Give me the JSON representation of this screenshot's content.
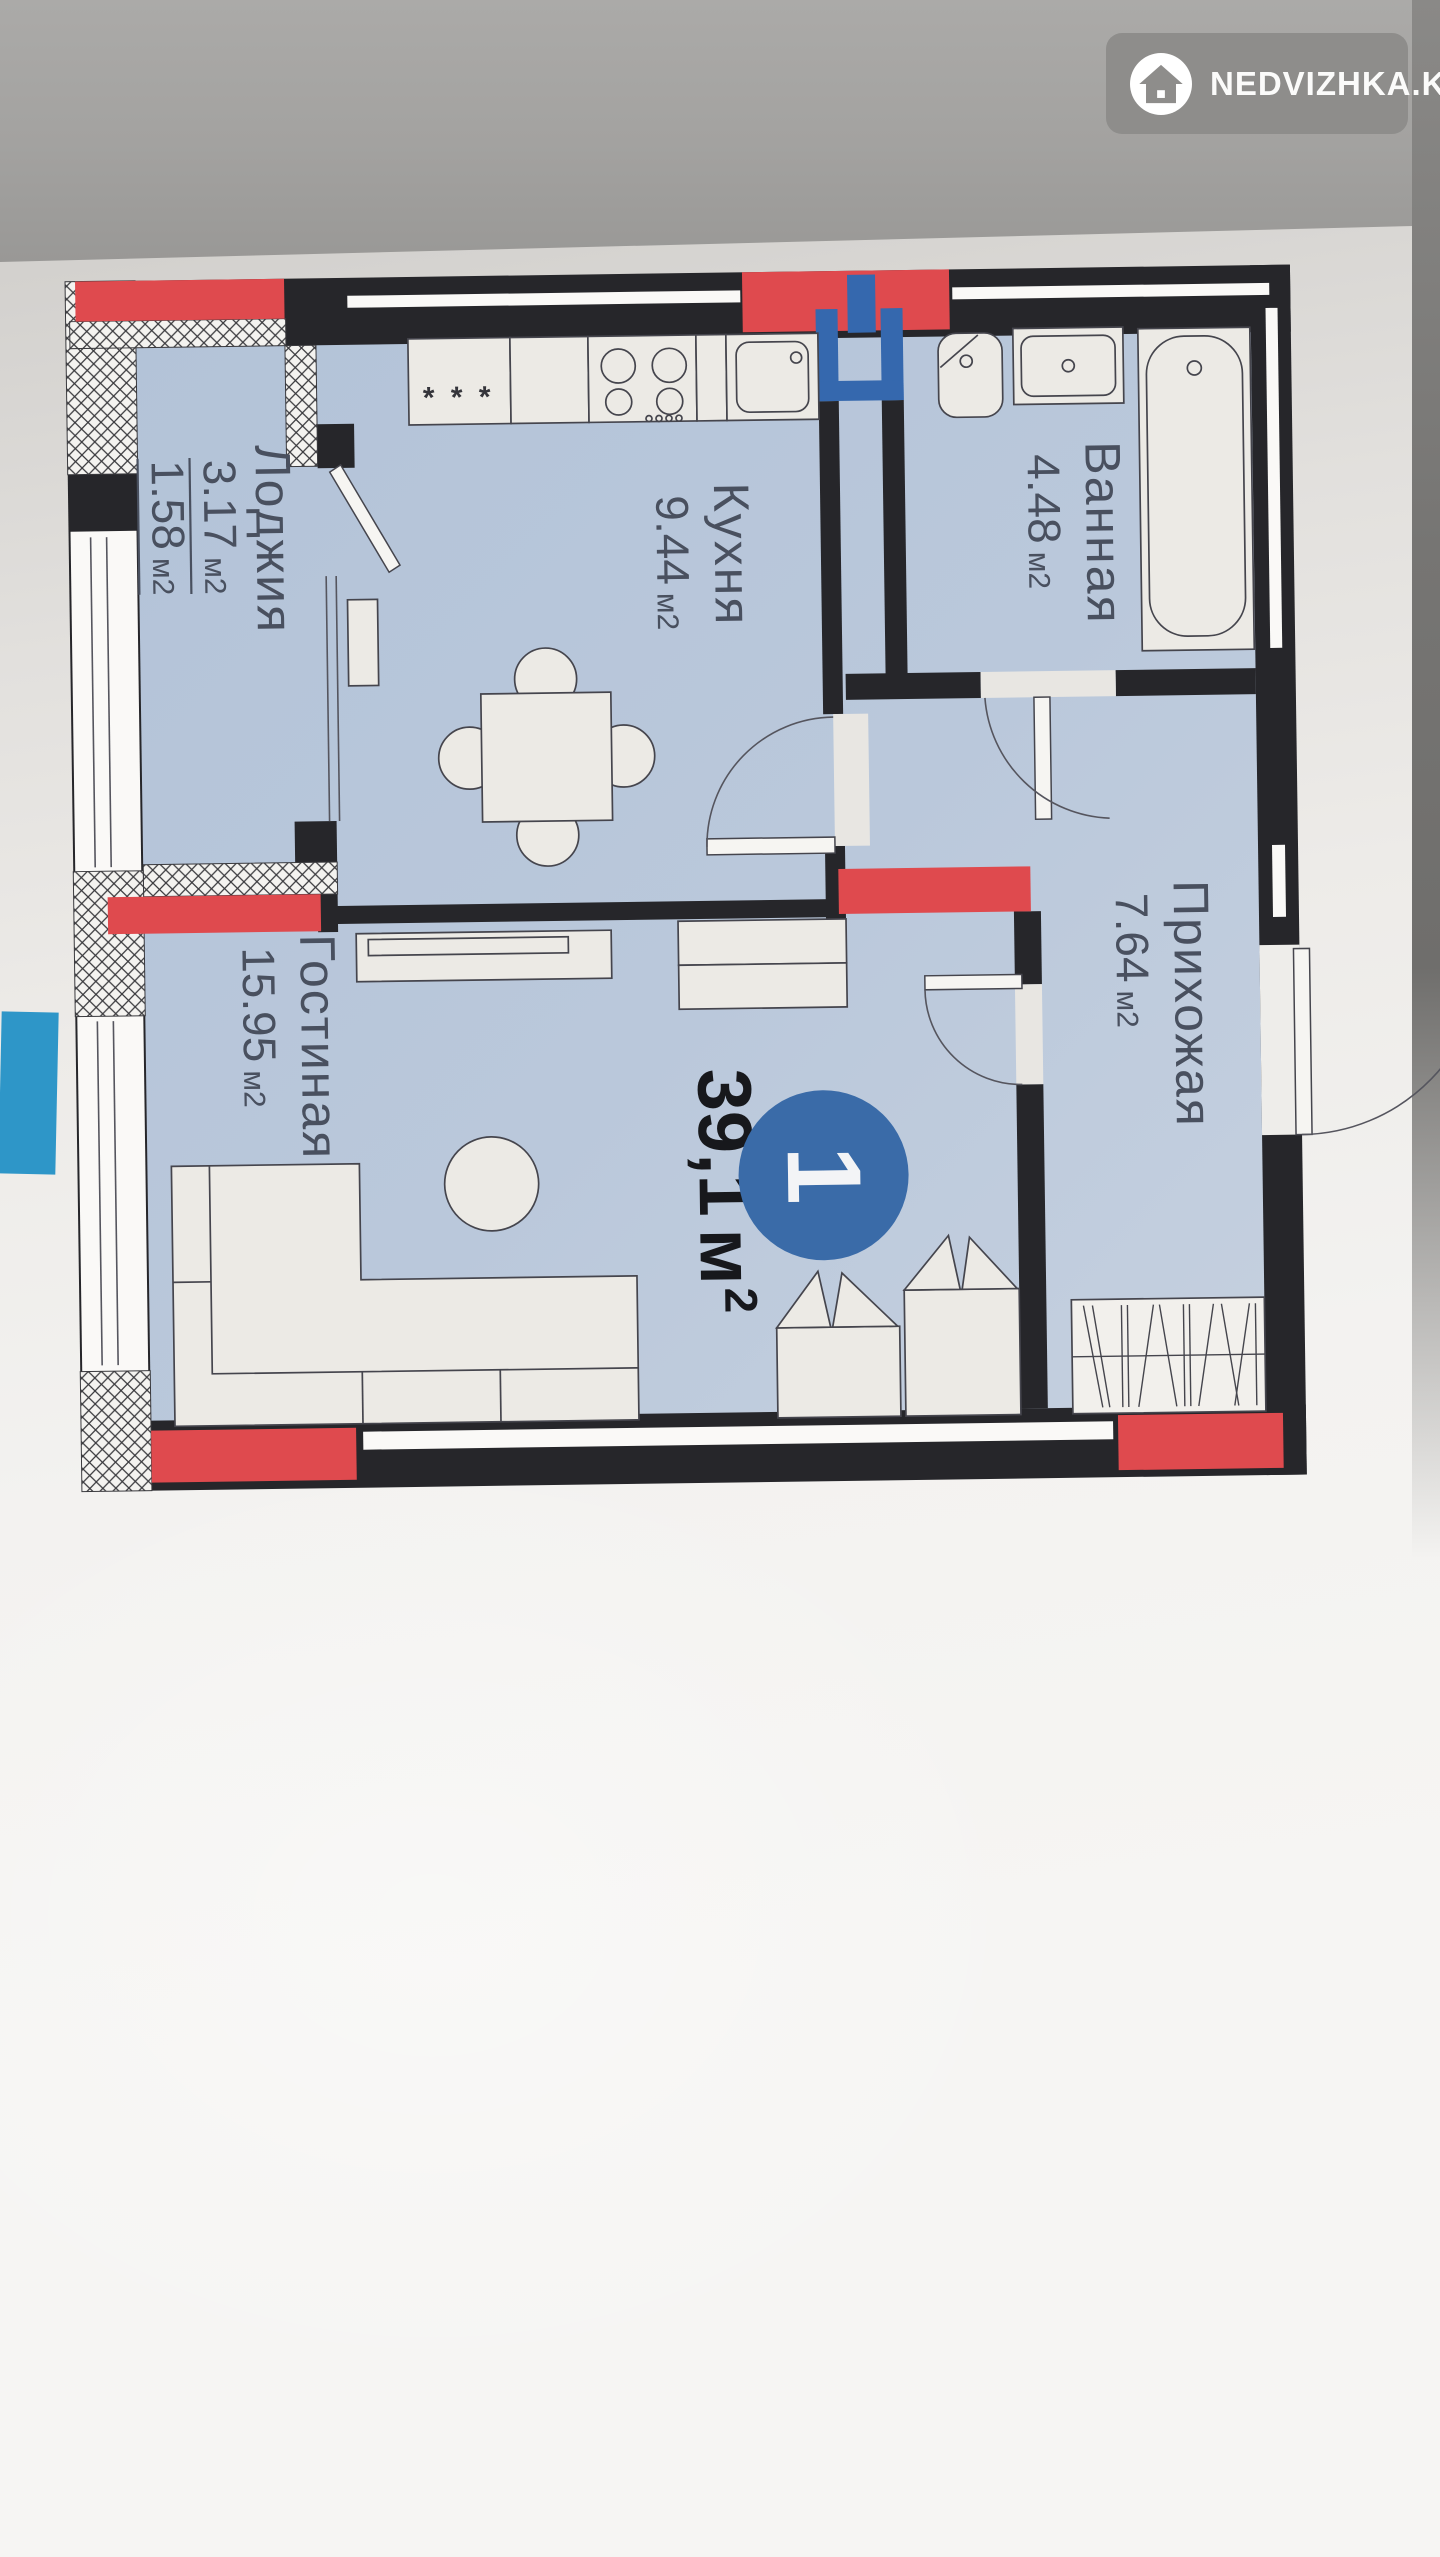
{
  "watermark": {
    "brand": "NEDVIZHKA.KZ",
    "icon": "house-icon"
  },
  "plan": {
    "unit_label": "1",
    "total": {
      "value": "39,1",
      "unit": "м",
      "sup": "2"
    },
    "rooms": [
      {
        "name": "Лоджия",
        "area": {
          "value": "3.17",
          "unit": "м2"
        },
        "area2": {
          "value": "1.58",
          "unit": "м2"
        }
      },
      {
        "name": "Кухня",
        "area": {
          "value": "9.44",
          "unit": "м2"
        }
      },
      {
        "name": "Ванная",
        "area": {
          "value": "4.48",
          "unit": "м2"
        }
      },
      {
        "name": "Прихожая",
        "area": {
          "value": "7.64",
          "unit": "м2"
        }
      },
      {
        "name": "Гостиная",
        "area": {
          "value": "15.95",
          "unit": "м2"
        }
      }
    ],
    "fridge_marks": "* * *",
    "colors": {
      "walls": "#26262a",
      "highlight_red": "#df4a4e",
      "room_fill": "#b7c6da",
      "vent_blue": "#3568ae",
      "unit_circle_blue": "#3a6ba8",
      "edge_object_blue": "#2e96c8"
    }
  }
}
